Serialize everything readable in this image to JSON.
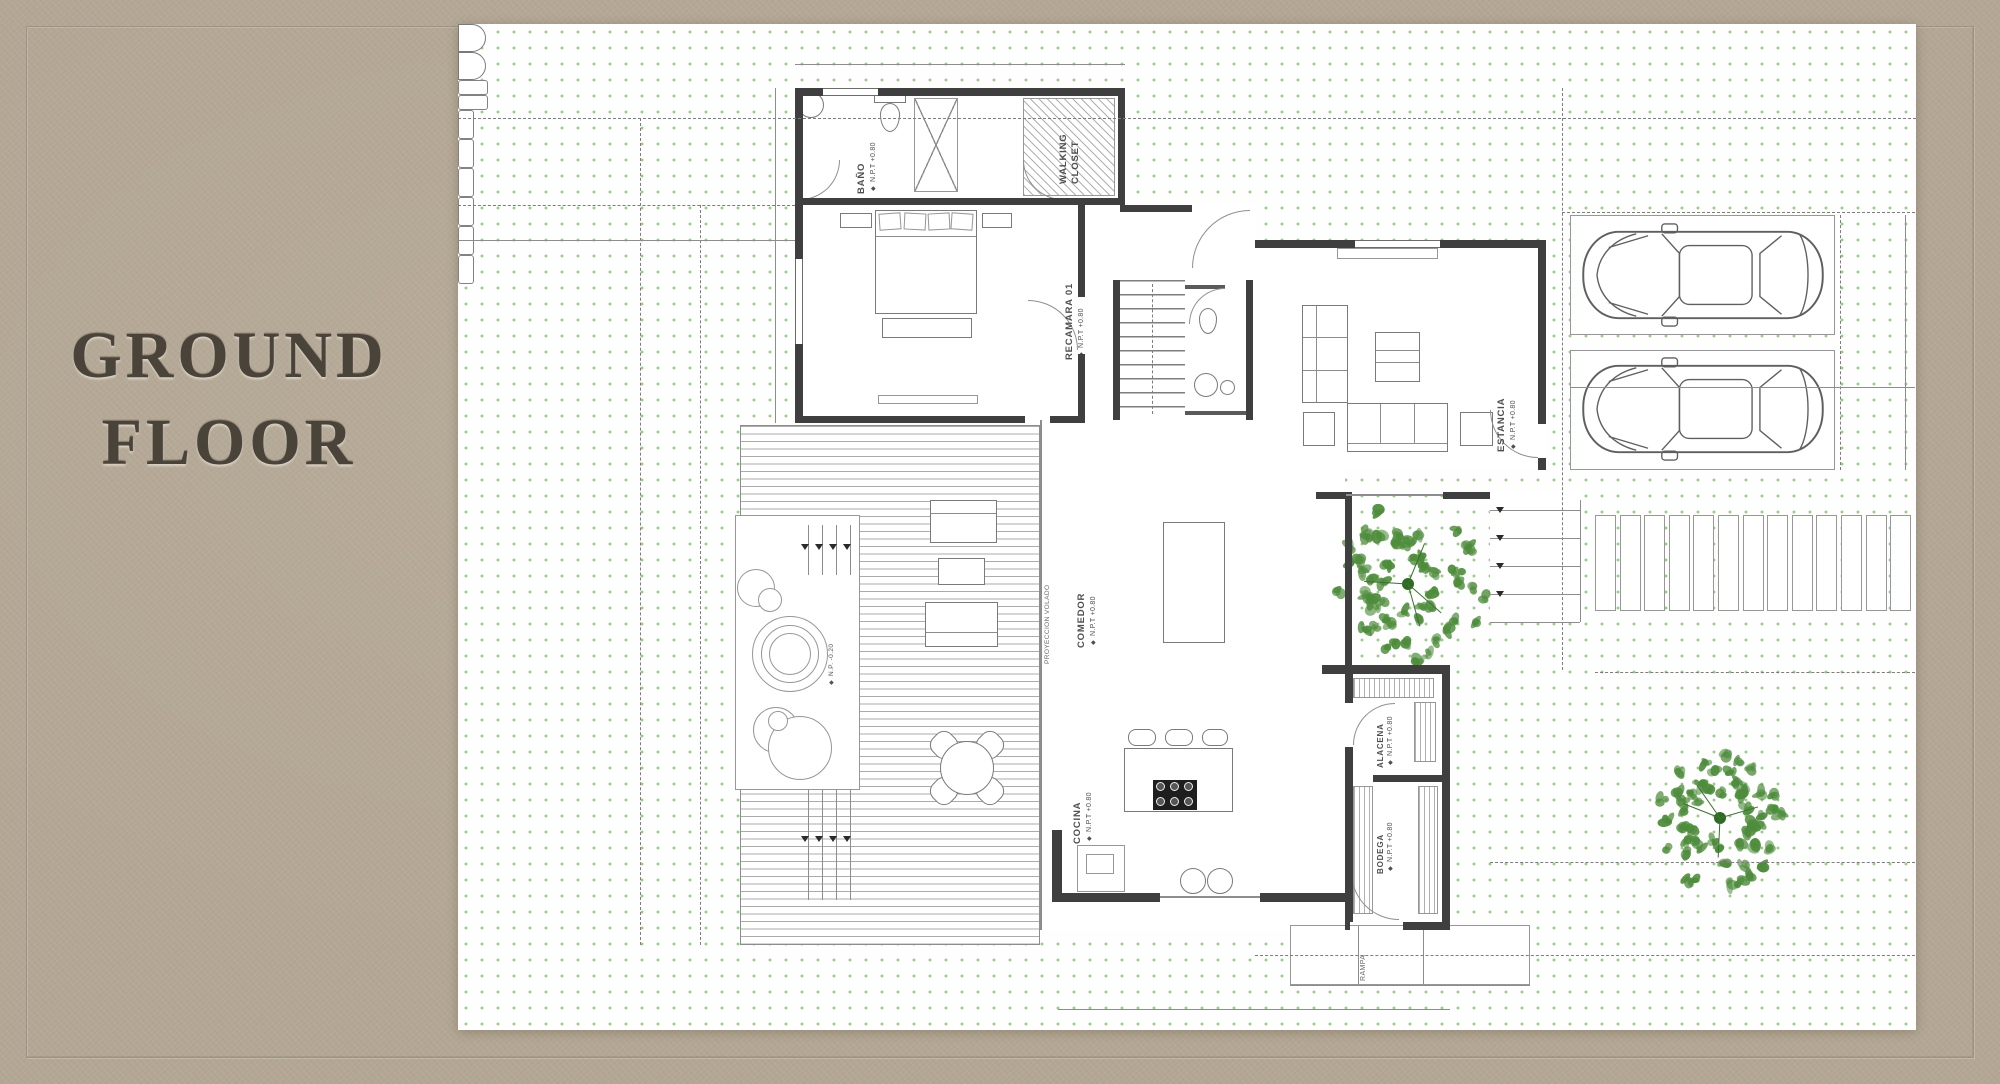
{
  "title": {
    "line1": "GROUND",
    "line2": "FLOOR"
  },
  "icons": {
    "level_marker": "◆"
  },
  "labels": {
    "bano": "BAÑO",
    "walking_closet": "WALKING CLOSET",
    "recamara": "RECAMARA 01",
    "estancia": "ESTANCIA",
    "comedor": "COMEDOR",
    "cocina": "COCINA",
    "alacena": "ALACENA",
    "bodega": "BODEGA",
    "rampa": "RAMPA",
    "projection": "PROYECCION VOLADO",
    "npt": "N.P.T +0.80",
    "np_water": "N.P. -0.20"
  },
  "colors": {
    "background": "#b3a694",
    "sheet": "#fefefe",
    "dots": "#9cc98e",
    "wall": "#3f3f3f",
    "title": "#49433a",
    "tree": "#4e8c3c"
  }
}
